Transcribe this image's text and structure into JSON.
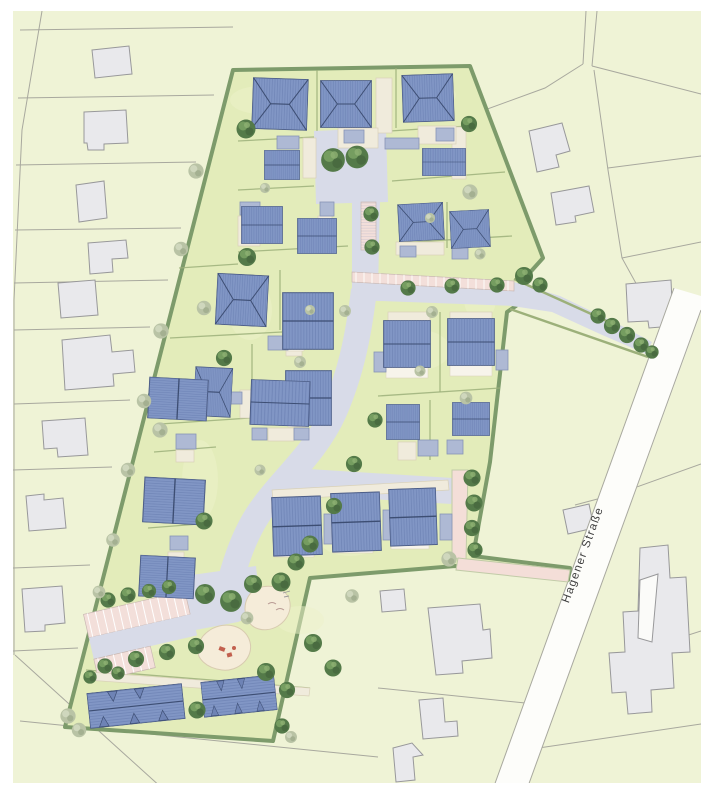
{
  "plan": {
    "street_label": "Hagener Straße"
  },
  "feature_names": [
    "development-site",
    "internal-street",
    "access-road",
    "visitor-parking",
    "residential-house",
    "garage",
    "driveway",
    "row-houses",
    "playground",
    "sand-area",
    "footpath",
    "street-tree",
    "hedge-boundary",
    "existing-building",
    "neighbour-parcel",
    "hagener-strasse-road"
  ],
  "colors": {
    "bg": "#ffffff",
    "map": "#eff3d6",
    "site": "#e3ecba",
    "hedge": "#7d9b6b",
    "street": "#d8dbe8",
    "roof": "#8196c5",
    "stripe": "#5d73a8",
    "ridge": "#3d4e73",
    "garage": "#aeb9d4",
    "drive": "#f0ebdc",
    "pink": "#f3dfda",
    "ppath": "#f4ded8",
    "sand": "#f5ecd9",
    "road": "#fdfdfa",
    "bldg": "#e9e9ec",
    "line": "#a8a89e",
    "pgreen": "#9cb07a",
    "treed": "#547a49",
    "treel": "#b9c3a5",
    "label": "#3f3f3f",
    "terr": "#f7f4eb",
    "whitebldg": "#fbfbf9",
    "equip": "#c2604e"
  }
}
